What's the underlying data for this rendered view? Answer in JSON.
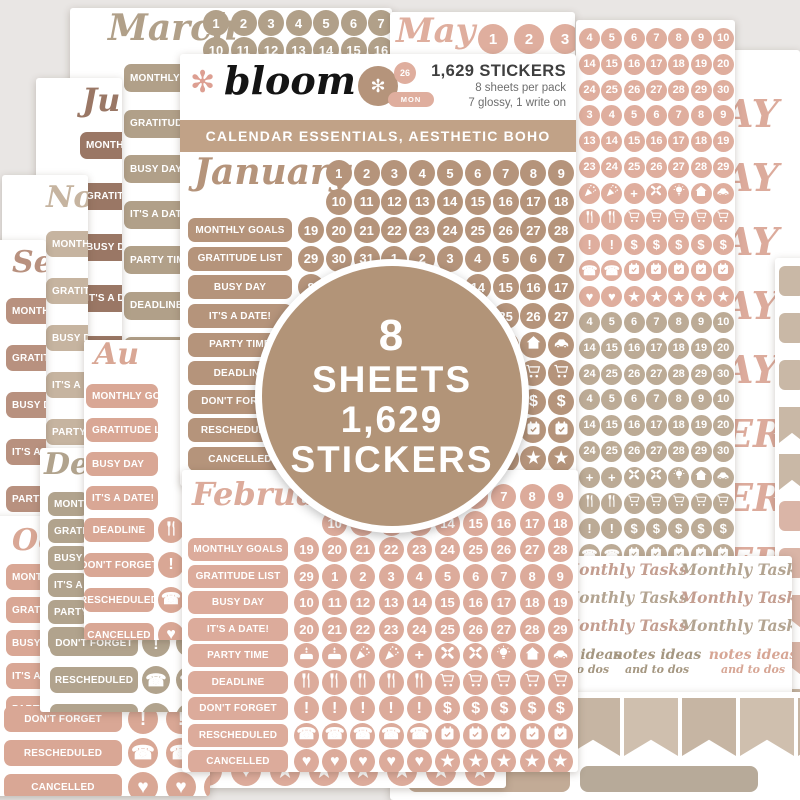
{
  "header": {
    "brand": "bloom",
    "count": "1,629 STICKERS",
    "info1": "8 sheets per pack",
    "info2": "7 glossy, 1 write on",
    "banner": "CALENDAR ESSENTIALS, AESTHETIC BOHO",
    "cluster_day": "26",
    "cluster_month": "MON"
  },
  "badge": {
    "lines": [
      "8",
      "SHEETS",
      "1,629",
      "STICKERS"
    ]
  },
  "label_set": [
    "MONTHLY GOALS",
    "GRATITUDE LIST",
    "BUSY DAY",
    "IT'S A DATE!",
    "PARTY TIME",
    "DEADLINE",
    "DON'T FORGET",
    "RESCHEDULED",
    "CANCELLED"
  ],
  "colors": {
    "bg": "#e9e6e4",
    "jan": "#b5947b",
    "feb": "#dcab9b",
    "march": "#b1a089",
    "may": "#dfae9e",
    "june": "#9a7765",
    "november": "#c6b4a0",
    "september": "#b8917f",
    "august": "#d9a795",
    "december": "#b1a38d",
    "october": "#d9a795",
    "taupe_grid": "#bcab96",
    "banner": "#c1a287",
    "badge": "#b29478",
    "flower": "#dd9f92",
    "text_dark": "#3f3f3f",
    "text_gray": "#6e6e6e",
    "mt1": "#c49e90",
    "mt2": "#b3a491",
    "notes1": "#a59781",
    "notes2": "#d7a695",
    "frag": "#dcab9c",
    "flag_taupe": "#c9b8a6",
    "flag_pink": "#dab5a7",
    "rect1": "#c2ab96",
    "rect2": "#b7aa99"
  },
  "bottom_right": {
    "monthly_tasks": "Monthly Tasks",
    "notes_line1": "notes ideas",
    "notes_line2": "and to dos"
  },
  "sheets": [
    {
      "id": "march",
      "kind": "month",
      "title": "March",
      "color": "march",
      "date_rows": [
        [
          "1",
          "2",
          "3",
          "4",
          "5",
          "6",
          "7",
          "8",
          "9"
        ],
        [
          "10",
          "11",
          "12",
          "13",
          "14",
          "15",
          "16",
          "17",
          "18"
        ]
      ],
      "labels": [
        0,
        1,
        2,
        3,
        4,
        5,
        6,
        7,
        8
      ]
    },
    {
      "id": "may-top",
      "kind": "maytop",
      "title": "May",
      "color": "may",
      "circles": [
        "1",
        "2",
        "3"
      ]
    },
    {
      "id": "month-names",
      "kind": "fragments",
      "color": "frag",
      "fragments": [
        "AY",
        "AY",
        "AY",
        "AY",
        "AY",
        "ER",
        "ER",
        "ER",
        "ER",
        "ER"
      ]
    },
    {
      "id": "flag-column",
      "kind": "flagcol",
      "items": [
        {
          "t": "sq",
          "c": "flag_taupe"
        },
        {
          "t": "sq",
          "c": "flag_taupe"
        },
        {
          "t": "sq",
          "c": "flag_taupe"
        },
        {
          "t": "flag",
          "c": "flag_taupe"
        },
        {
          "t": "flag",
          "c": "flag_taupe"
        },
        {
          "t": "sq",
          "c": "flag_pink"
        },
        {
          "t": "sq",
          "c": "flag_pink"
        },
        {
          "t": "flag",
          "c": "flag_pink"
        },
        {
          "t": "flag",
          "c": "flag_pink"
        },
        {
          "t": "sq",
          "c": "flag_taupe"
        },
        {
          "t": "sq",
          "c": "flag_taupe"
        }
      ]
    },
    {
      "id": "right-grid",
      "kind": "grid2",
      "blocks": [
        {
          "color": "may",
          "rows": [
            [
              "4",
              "5",
              "6",
              "7",
              "8",
              "9",
              "10"
            ],
            [
              "14",
              "15",
              "16",
              "17",
              "18",
              "19",
              "20"
            ],
            [
              "24",
              "25",
              "26",
              "27",
              "28",
              "29",
              "30"
            ],
            [
              "3",
              "4",
              "5",
              "6",
              "7",
              "8",
              "9"
            ],
            [
              "13",
              "14",
              "15",
              "16",
              "17",
              "18",
              "19"
            ],
            [
              "23",
              "24",
              "25",
              "26",
              "27",
              "28",
              "29"
            ],
            [
              "i:popper",
              "i:popper",
              "i:plus",
              "i:tools",
              "i:bulb",
              "i:house",
              "i:car"
            ],
            [
              "i:utensil",
              "i:utensil",
              "i:cart",
              "i:cart",
              "i:cart",
              "i:cart",
              "i:cart"
            ],
            [
              "i:excl",
              "i:excl",
              "i:dollar",
              "i:dollar",
              "i:dollar",
              "i:dollar",
              "i:dollar"
            ],
            [
              "i:phone",
              "i:phone",
              "i:cal",
              "i:cal",
              "i:cal",
              "i:cal",
              "i:cal"
            ],
            [
              "i:heart",
              "i:heart",
              "i:star",
              "i:star",
              "i:star",
              "i:star",
              "i:star"
            ]
          ]
        },
        {
          "color": "taupe_grid",
          "rows": [
            [
              "4",
              "5",
              "6",
              "7",
              "8",
              "9",
              "10"
            ],
            [
              "14",
              "15",
              "16",
              "17",
              "18",
              "19",
              "20"
            ],
            [
              "24",
              "25",
              "26",
              "27",
              "28",
              "29",
              "30"
            ],
            [
              "4",
              "5",
              "6",
              "7",
              "8",
              "9",
              "10"
            ],
            [
              "14",
              "15",
              "16",
              "17",
              "18",
              "19",
              "20"
            ],
            [
              "24",
              "25",
              "26",
              "27",
              "28",
              "29",
              "30"
            ],
            [
              "i:plus",
              "i:plus",
              "i:tools",
              "i:tools",
              "i:bulb",
              "i:house",
              "i:car"
            ],
            [
              "i:utensil",
              "i:utensil",
              "i:cart",
              "i:cart",
              "i:cart",
              "i:cart",
              "i:cart"
            ],
            [
              "i:excl",
              "i:excl",
              "i:dollar",
              "i:dollar",
              "i:dollar",
              "i:dollar",
              "i:dollar"
            ],
            [
              "i:phone",
              "i:phone",
              "i:cal",
              "i:cal",
              "i:cal",
              "i:cal",
              "i:cal"
            ],
            [
              "i:heart",
              "i:heart",
              "i:star",
              "i:star",
              "i:star",
              "i:star",
              "i:star"
            ]
          ]
        }
      ]
    },
    {
      "id": "monthly-tasks",
      "kind": "tasks"
    },
    {
      "id": "bottom-flags",
      "kind": "flagsrow"
    },
    {
      "id": "peek",
      "kind": "peek",
      "color": "feb",
      "icons": [
        "heart",
        "heart",
        "star",
        "star",
        "star",
        "star",
        "star",
        "star"
      ]
    },
    {
      "id": "june",
      "kind": "month",
      "title": "Ju",
      "color": "june",
      "labels": [
        0,
        1,
        2,
        3,
        4,
        5,
        6,
        7,
        8
      ]
    },
    {
      "id": "november",
      "kind": "month",
      "title": "Nov",
      "color": "november",
      "labels": [
        0,
        1,
        2,
        3,
        4,
        5,
        6,
        7,
        8
      ]
    },
    {
      "id": "september",
      "kind": "month",
      "title": "Sep",
      "color": "september",
      "labels": [
        0,
        1,
        2,
        3,
        4,
        5,
        6,
        7,
        8
      ]
    },
    {
      "id": "october",
      "kind": "month",
      "title": "Oc",
      "color": "october",
      "labels": [
        0,
        1,
        2,
        3,
        4
      ],
      "full_rows": [
        {
          "label": 6,
          "icons": [
            "excl",
            "excl",
            "excl",
            "excl"
          ]
        },
        {
          "label": 7,
          "icons": [
            "phone",
            "phone",
            "phone",
            "phone"
          ]
        },
        {
          "label": 8,
          "icons": [
            "heart",
            "heart",
            "heart",
            "heart"
          ]
        }
      ]
    },
    {
      "id": "december",
      "kind": "month",
      "title": "De",
      "color": "december",
      "labels": [
        0,
        1,
        2,
        3,
        4,
        5
      ],
      "full_rows": [
        {
          "label": 6,
          "icons": [
            "excl",
            "excl"
          ]
        },
        {
          "label": 7,
          "icons": [
            "phone",
            "phone"
          ]
        },
        {
          "label": 8,
          "icons": [
            "heart",
            "heart"
          ]
        }
      ]
    },
    {
      "id": "august",
      "kind": "month",
      "title": "Au",
      "color": "august",
      "labels": [
        0,
        1,
        2,
        3
      ],
      "full_rows": [
        {
          "label": 5,
          "icons": [
            "utensil"
          ]
        },
        {
          "label": 6,
          "icons": [
            "excl"
          ]
        },
        {
          "label": 7,
          "icons": [
            "phone"
          ]
        },
        {
          "label": 8,
          "icons": [
            "heart"
          ]
        }
      ]
    },
    {
      "id": "january",
      "kind": "main",
      "title": "January",
      "color": "jan",
      "labels": [
        0,
        1,
        2,
        3,
        4,
        5,
        6,
        7,
        8
      ],
      "date_rows": [
        [
          "1",
          "2",
          "3",
          "4",
          "5",
          "6",
          "7",
          "8",
          "9"
        ],
        [
          "10",
          "11",
          "12",
          "13",
          "14",
          "15",
          "16",
          "17",
          "18"
        ],
        [
          "19",
          "20",
          "21",
          "22",
          "23",
          "24",
          "25",
          "26",
          "27",
          "28"
        ],
        [
          "29",
          "30",
          "31",
          "1",
          "2",
          "3",
          "4",
          "5",
          "6",
          "7"
        ],
        [
          "8",
          "9",
          "10",
          "11",
          "12",
          "13",
          "14",
          "15",
          "16",
          "17"
        ],
        [
          "18",
          "19",
          "20",
          "21",
          "22",
          "23",
          "24",
          "25",
          "26",
          "27"
        ]
      ],
      "icon_rows": [
        [
          "i:cake",
          "i:cake",
          "i:popper",
          "i:popper",
          "i:plus",
          "i:tools",
          "i:tools",
          "i:bulb",
          "i:house",
          "i:car"
        ],
        [
          "i:utensil",
          "i:utensil",
          "i:utensil",
          "i:utensil",
          "i:utensil",
          "i:cart",
          "i:cart",
          "i:cart",
          "i:cart",
          "i:cart"
        ],
        [
          "i:excl",
          "i:excl",
          "i:excl",
          "i:excl",
          "i:excl",
          "i:dollar",
          "i:dollar",
          "i:dollar",
          "i:dollar",
          "i:dollar"
        ],
        [
          "i:phone",
          "i:phone",
          "i:phone",
          "i:phone",
          "i:phone",
          "i:cal",
          "i:cal",
          "i:cal",
          "i:cal",
          "i:cal"
        ],
        [
          "i:heart",
          "i:heart",
          "i:heart",
          "i:heart",
          "i:heart",
          "i:star",
          "i:star",
          "i:star",
          "i:star",
          "i:star"
        ]
      ]
    },
    {
      "id": "february",
      "kind": "month",
      "title": "February",
      "color": "feb",
      "labels": [
        0,
        1,
        2,
        3,
        4,
        5,
        6,
        7,
        8
      ],
      "date_rows": [
        [
          "1",
          "2",
          "3",
          "4",
          "5",
          "6",
          "7",
          "8",
          "9"
        ],
        [
          "10",
          "11",
          "12",
          "13",
          "14",
          "15",
          "16",
          "17",
          "18"
        ],
        [
          "19",
          "20",
          "21",
          "22",
          "23",
          "24",
          "25",
          "26",
          "27",
          "28"
        ],
        [
          "29",
          "1",
          "2",
          "3",
          "4",
          "5",
          "6",
          "7",
          "8",
          "9"
        ],
        [
          "10",
          "11",
          "12",
          "13",
          "14",
          "15",
          "16",
          "17",
          "18",
          "19"
        ],
        [
          "20",
          "21",
          "22",
          "23",
          "24",
          "25",
          "26",
          "27",
          "28",
          "29"
        ]
      ],
      "icon_rows": [
        [
          "i:cake",
          "i:cake",
          "i:popper",
          "i:popper",
          "i:plus",
          "i:tools",
          "i:tools",
          "i:bulb",
          "i:house",
          "i:car"
        ],
        [
          "i:utensil",
          "i:utensil",
          "i:utensil",
          "i:utensil",
          "i:utensil",
          "i:cart",
          "i:cart",
          "i:cart",
          "i:cart",
          "i:cart"
        ],
        [
          "i:excl",
          "i:excl",
          "i:excl",
          "i:excl",
          "i:excl",
          "i:dollar",
          "i:dollar",
          "i:dollar",
          "i:dollar",
          "i:dollar"
        ],
        [
          "i:phone",
          "i:phone",
          "i:phone",
          "i:phone",
          "i:phone",
          "i:cal",
          "i:cal",
          "i:cal",
          "i:cal",
          "i:cal"
        ],
        [
          "i:heart",
          "i:heart",
          "i:heart",
          "i:heart",
          "i:heart",
          "i:star",
          "i:star",
          "i:star",
          "i:star",
          "i:star"
        ]
      ]
    }
  ]
}
